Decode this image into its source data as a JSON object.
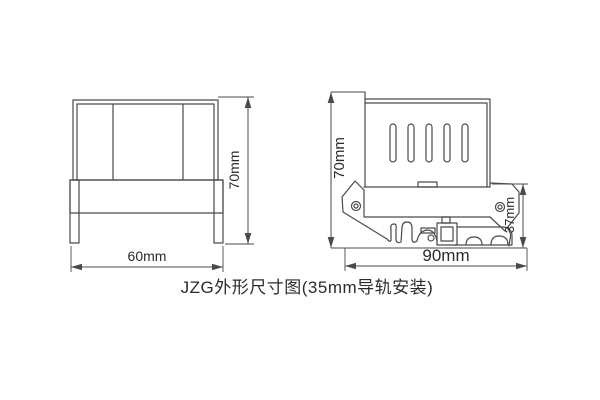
{
  "caption": {
    "text": "JZG外形尺寸图(35mm导轨安装)"
  },
  "front_view": {
    "width_label": "60mm",
    "height_label": "70mm"
  },
  "side_view": {
    "height_label": "70mm",
    "rail_height_label": "37mm",
    "width_label": "90mm"
  },
  "colors": {
    "line": "#4a4a4a",
    "text": "#2b2b2b",
    "background": "#ffffff"
  }
}
